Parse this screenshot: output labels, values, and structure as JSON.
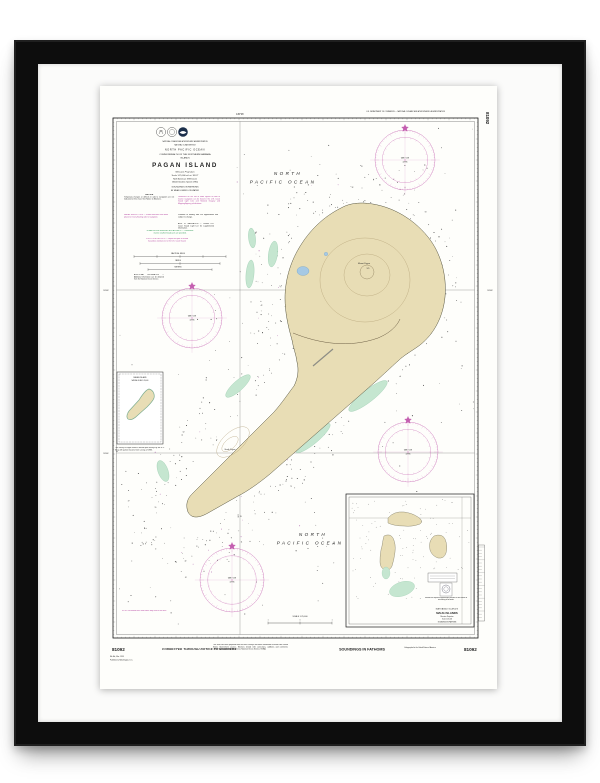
{
  "colors": {
    "magenta": "#b13a9c",
    "rose": "#c45fb0",
    "land": "#e8ddb5",
    "reef": "#c5e6d0",
    "lake": "#a6c9e4",
    "green_note": "#27964f",
    "ink": "#222222"
  },
  "chart": {
    "number": "81092",
    "top_margin": {
      "agency_line": "U.S. DEPARTMENT OF COMMERCE — NATIONAL OCEANIC AND ATMOSPHERIC ADMINISTRATION",
      "meridian_label": "145°46'"
    },
    "margin_labels": {
      "lat1": "18°08'",
      "lat2": "18°06'"
    },
    "title_block": {
      "agency1": "NATIONAL OCEANIC AND ATMOSPHERIC ADMINISTRATION",
      "agency2": "NATIONAL OCEAN SERVICE",
      "ocean": "NORTH PACIFIC OCEAN",
      "region1": "COMMONWEALTH OF THE NORTHERN MARIANA",
      "region2": "ISLANDS",
      "title": "PAGAN ISLAND",
      "projection": "Mercator Projection",
      "scale": "Scale 1:25,000 at Lat. 18°07'",
      "datum1": "North American 1983 Datum",
      "datum2": "(World Geodetic System 1984)",
      "soundings1": "SOUNDINGS IN FATHOMS",
      "soundings2": "AT MEAN LOWER LOW WATER"
    },
    "notes": {
      "caution_title": "CAUTION",
      "caution_body": "Temporary changes or defects in aids to navigation are not indicated on this chart. See Notice to Mariners.",
      "radio_note": "Limitations on the use of radio signals as aids to marine navigation can be found in the U.S. Coast Guard Light Lists and National Imagery and Mapping Agency publications.",
      "radar_note": "RADAR REFLECTORS — Radar reflectors have been placed on many floating aids to navigation.",
      "floating_note": "Positions of floating aids are approximate and subject to change.",
      "aids_note": "AIDS TO NAVIGATION — Consult U.S. Coast Guard Light List for supplemental information.",
      "weather_note": "NOAA VHF-FM WEATHER BROADCASTS — Continuous marine weather broadcasts are provided.",
      "pollution_note": "POLLUTION REPORTS — Report all spills of oil and hazardous substances to the U.S. Coast Guard.",
      "info_note": "ADDITIONAL INFORMATION — Additional information can be obtained from the National Ocean Service.",
      "bar_nm": "NAUTICAL MILES",
      "bar_yd": "YARDS",
      "bar_m": "METERS"
    },
    "ocean_label": {
      "line1": "NORTH",
      "line2": "PACIFIC   OCEAN"
    },
    "island_labels": {
      "mount": "Mount Pagan",
      "south": "South Pagan",
      "elev": "570"
    },
    "left_inset": {
      "title": "PAGAN ISLAND",
      "subtitle": "NATURAL SCALE 1:250,000",
      "caption": "The survey of Pagan Island is based upon surveys by the U.S. Navy with partial revisions from surveys of 1983."
    },
    "corner_note": "NOTE: Uncharted rocks and shoals may exist in this area.",
    "bottom_scale": {
      "line1": "SCALE 1:25,000",
      "zero": "0",
      "one": "1"
    },
    "rose": {
      "var1": "VAR 1°15'E",
      "var2": "(1999)"
    },
    "maug_inset": {
      "region": "MARIANA ISLANDS",
      "title": "MAUG ISLANDS",
      "sub1": "Mercator Projection",
      "sub2": "Scale 1:25,000",
      "soundings": "SOUNDINGS IN FATHOMS",
      "note": "Dashed lines represent approximate positions of reefs awash or uncovering at low water."
    },
    "bottom_margin": {
      "number_left": "81092",
      "number_right": "81092",
      "edition": "8th Ed., Mar. 1999",
      "edition2": "Published at Washington, D.C.",
      "stamp": "CORRECTED THROUGH NOTICE TO MARINERS",
      "paragraph": "This chart has been prepared from the latest surveys and other information received from United States Government sources. Mariners should refer corrections, additions and comments concerning this chart to the Director, National Ocean Service, NOAA.",
      "soundings": "SOUNDINGS IN FATHOMS",
      "print_note": "Lithographed in the United States of America"
    },
    "side_number": "81092"
  }
}
